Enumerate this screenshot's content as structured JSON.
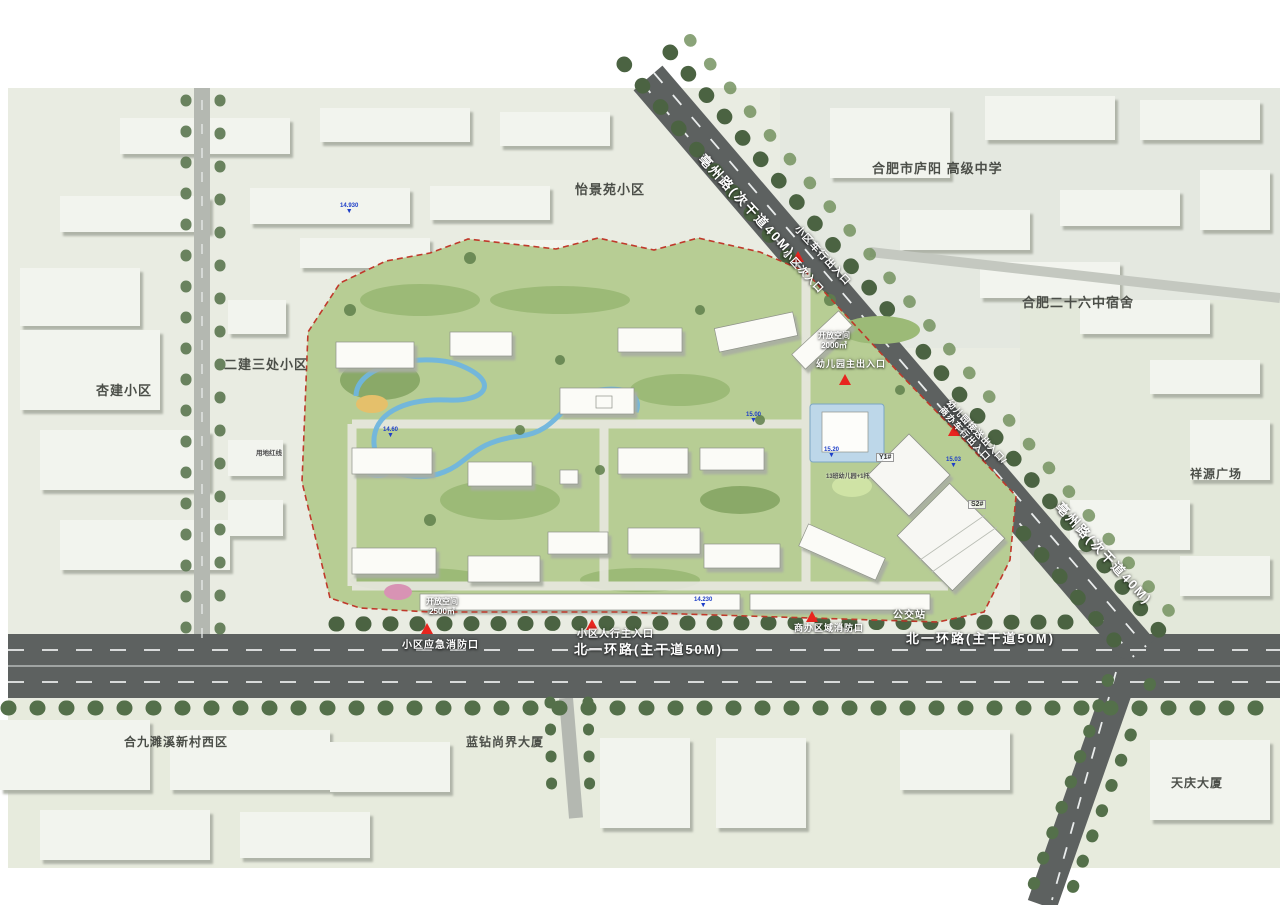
{
  "surroundings": {
    "yijingyuan": "怡景苑小区",
    "luyang_school": "合肥市庐阳 高级中学",
    "no26_dorm": "合肥二十六中宿舍",
    "xiangyuan_plaza": "祥源广场",
    "erjian_sanchu": "二建三处小区",
    "xingjian": "杏建小区",
    "hejiu_suixi": "合九濉溪新村西区",
    "lanzuan_tower": "蓝钻尚界大厦",
    "tianqing_tower": "天庆大厦"
  },
  "roads": {
    "bozhou_road": "亳州路(次干道40M)",
    "north_first_ring": "北一环路(主干道50M)"
  },
  "entrances": {
    "vehicle_exit": "小区车行出入口",
    "secondary_entry": "小区次入口",
    "kg_dropoff_line1": "幼儿园接送出入口/",
    "kg_dropoff_line2": "商办车行出入口",
    "kg_main": "幼儿园主出入口",
    "pedestrian_main": "小区人行主入口",
    "emergency_fire": "小区应急消防口",
    "biz_fire": "商办区域消防口",
    "bus_stop": "公交站"
  },
  "site": {
    "open_space_a_line1": "开放空间",
    "open_space_a_line2": "2500㎡",
    "open_space_b_line1": "开放空间",
    "open_space_b_line2": "2000㎡",
    "red_line": "用地红线",
    "building_y1": "Y1#",
    "building_s2": "S2#",
    "kindergarten": "13班幼儿园+1托"
  },
  "elevations": {
    "e1": "14.930",
    "e2": "14.60",
    "e3": "15.00",
    "e4": "15.03",
    "e5": "15.20",
    "e6": "14.230"
  },
  "colors": {
    "boundary_red": "#c0392b",
    "entrance_red": "#e8251f",
    "marker_blue": "#1d3ec8",
    "water_blue": "#6fb5de",
    "road_gray": "#5d6160",
    "site_green": "#b7cd94"
  }
}
